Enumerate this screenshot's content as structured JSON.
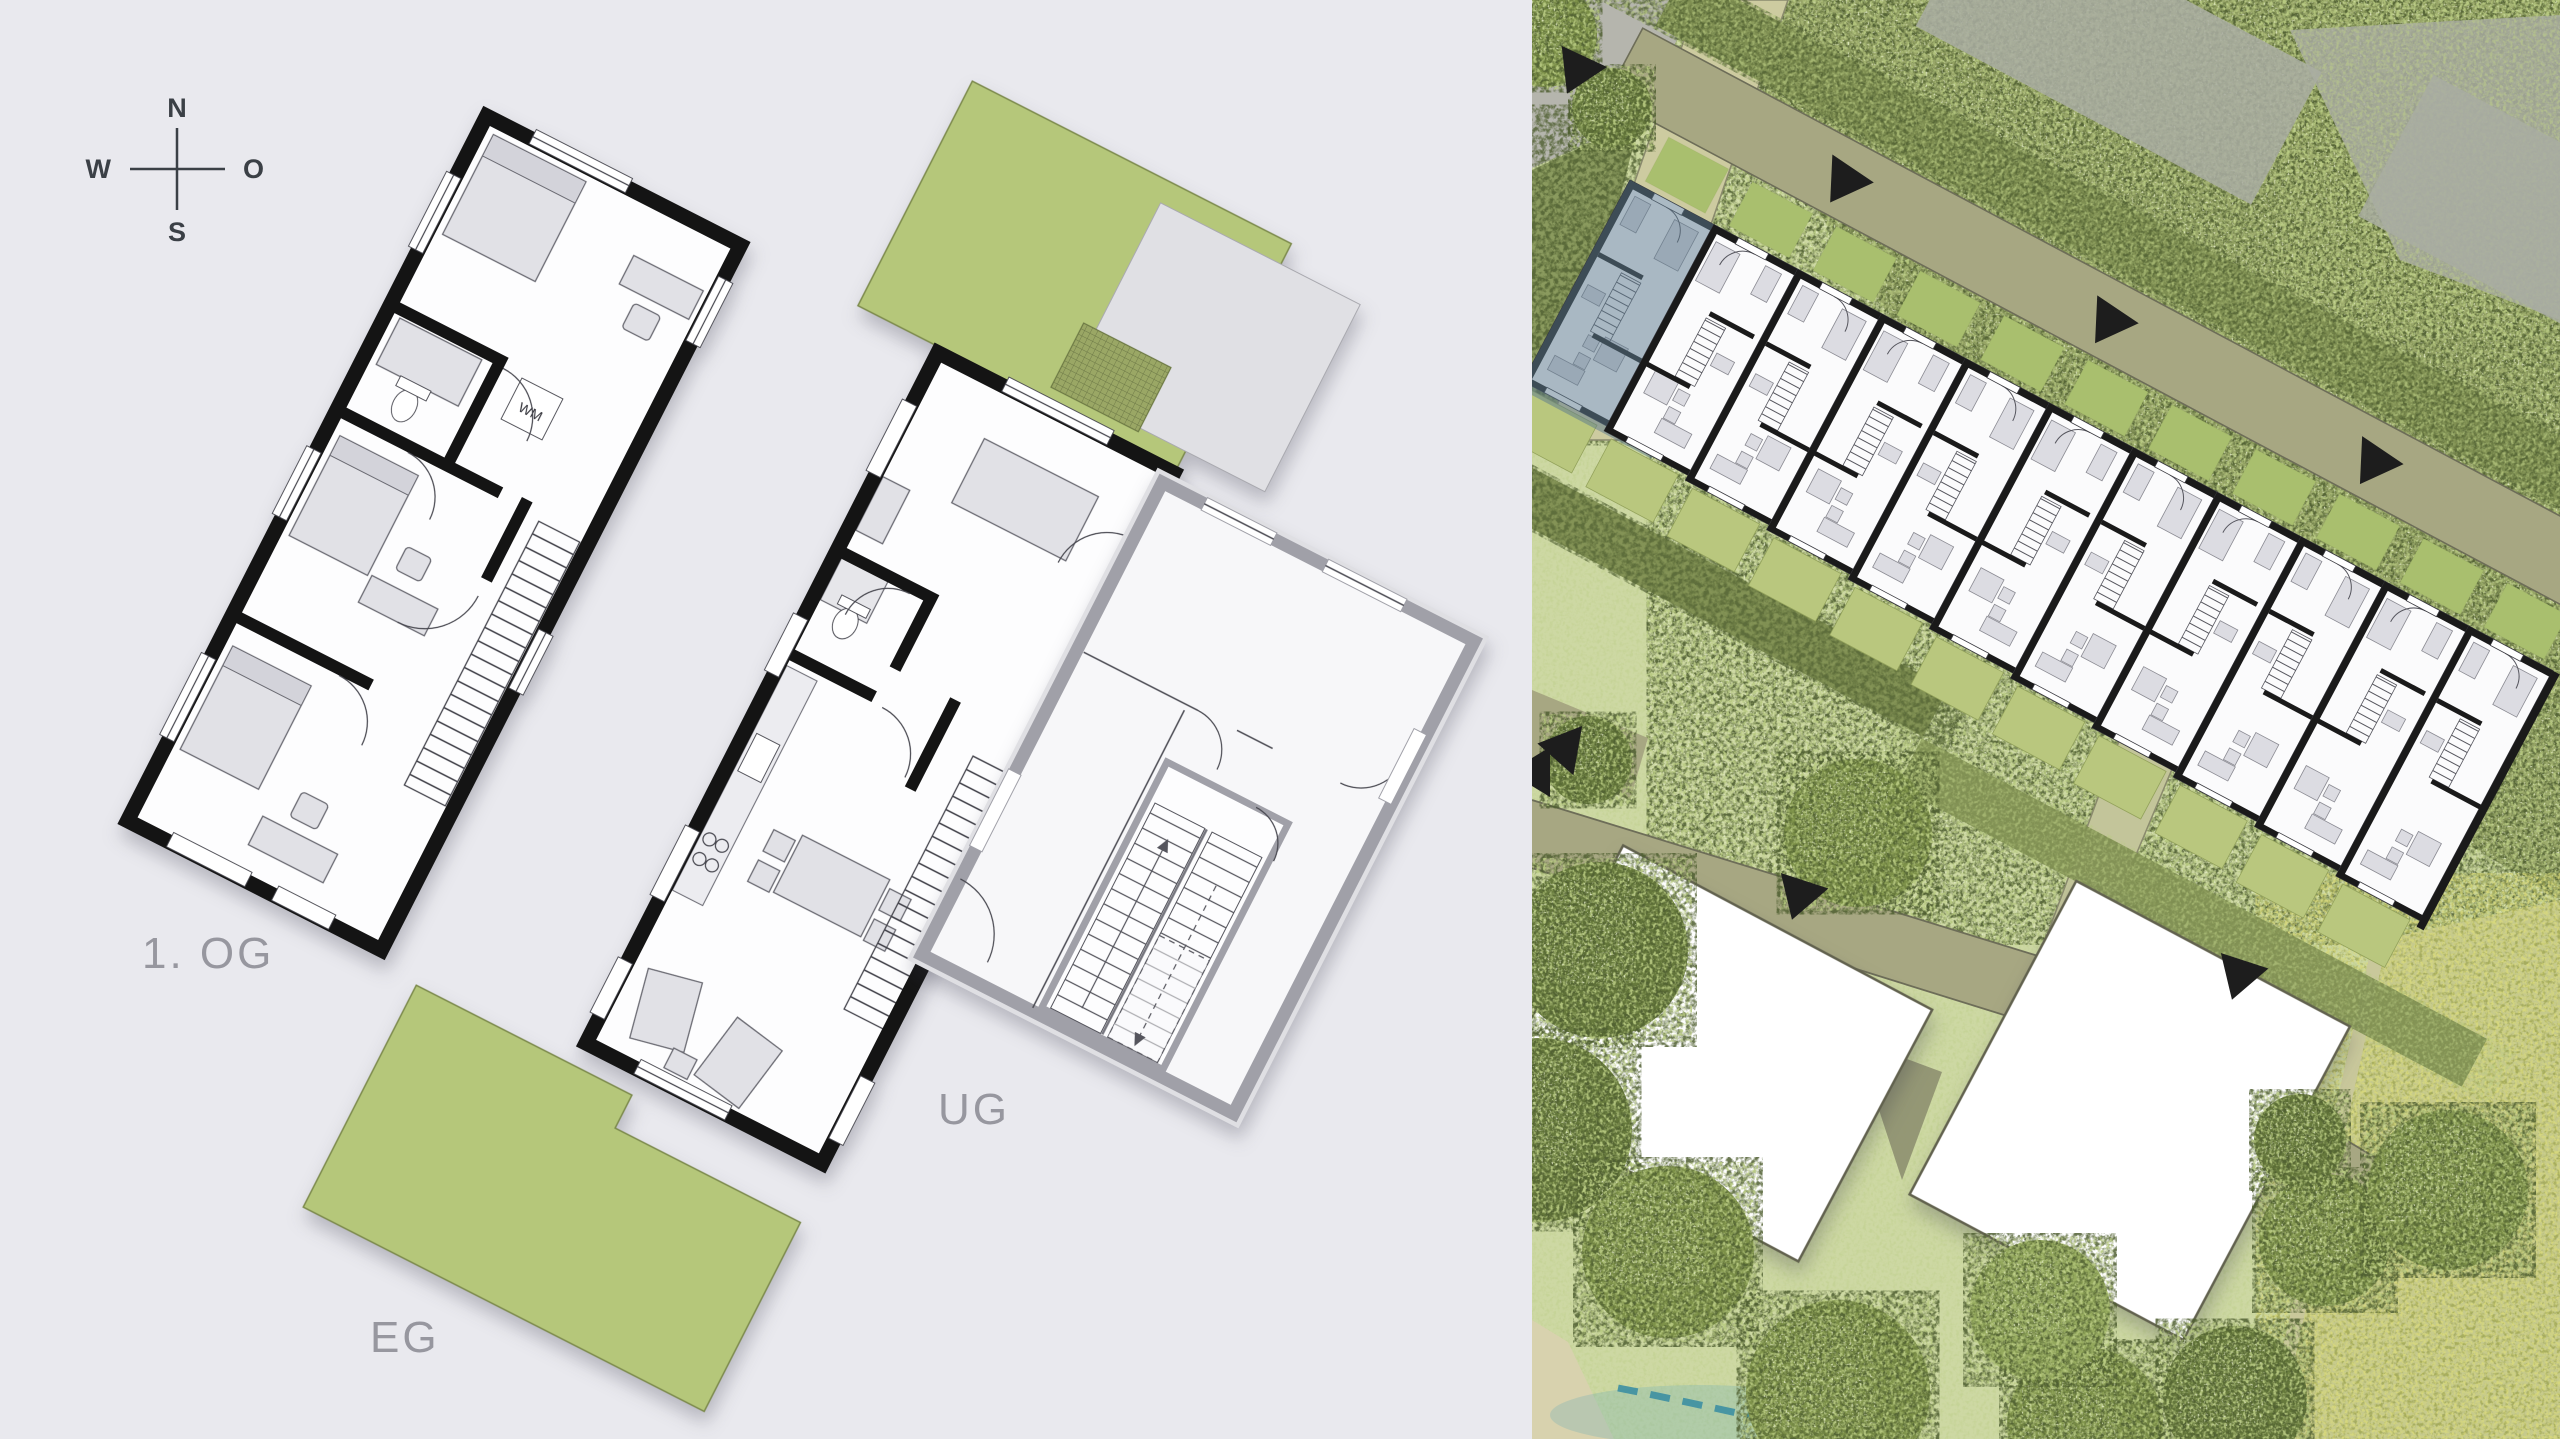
{
  "left_panel": {
    "background_color": "#e9e9ee",
    "compass": {
      "north": "N",
      "east": "O",
      "south": "S",
      "west": "W"
    },
    "floors": {
      "upper": {
        "label": "1. OG"
      },
      "ground": {
        "label": "EG"
      },
      "basement": {
        "label": "UG"
      }
    },
    "appliance_labels": {
      "washing_machine": "WM"
    },
    "colors": {
      "wall_black": "#141414",
      "terrace_green": "#b5c77a",
      "furniture_gray": "#e1e1e6",
      "label_gray": "#97979f",
      "ug_wall_gray": "#a0a0a8"
    }
  },
  "site_panel": {
    "row_house_units": 11,
    "highlighted_unit_index": 0,
    "entrance_marker_count": 8,
    "colors": {
      "highlight_blue": "#5e7a8e",
      "canopy_green": "#97a567",
      "lawn_green": "#cdd8a3",
      "meadow_green": "#c6ca8c",
      "path_khaki": "#a7a782",
      "path_light_khaki": "#c6c59c",
      "hedge_olive": "#7f8f52",
      "unit_terrace_green": "#a9bf6e",
      "garden_green": "#b9c77e",
      "marker_black": "#1d1d1d",
      "building_white": "#ffffff",
      "unit_wall_black": "#1a1a1a",
      "unit_furniture": "#dcdce2",
      "water_teal": "#3d8fa2",
      "ground_gray": "#a9ada2",
      "sand_tan": "#d8d2ae"
    }
  }
}
